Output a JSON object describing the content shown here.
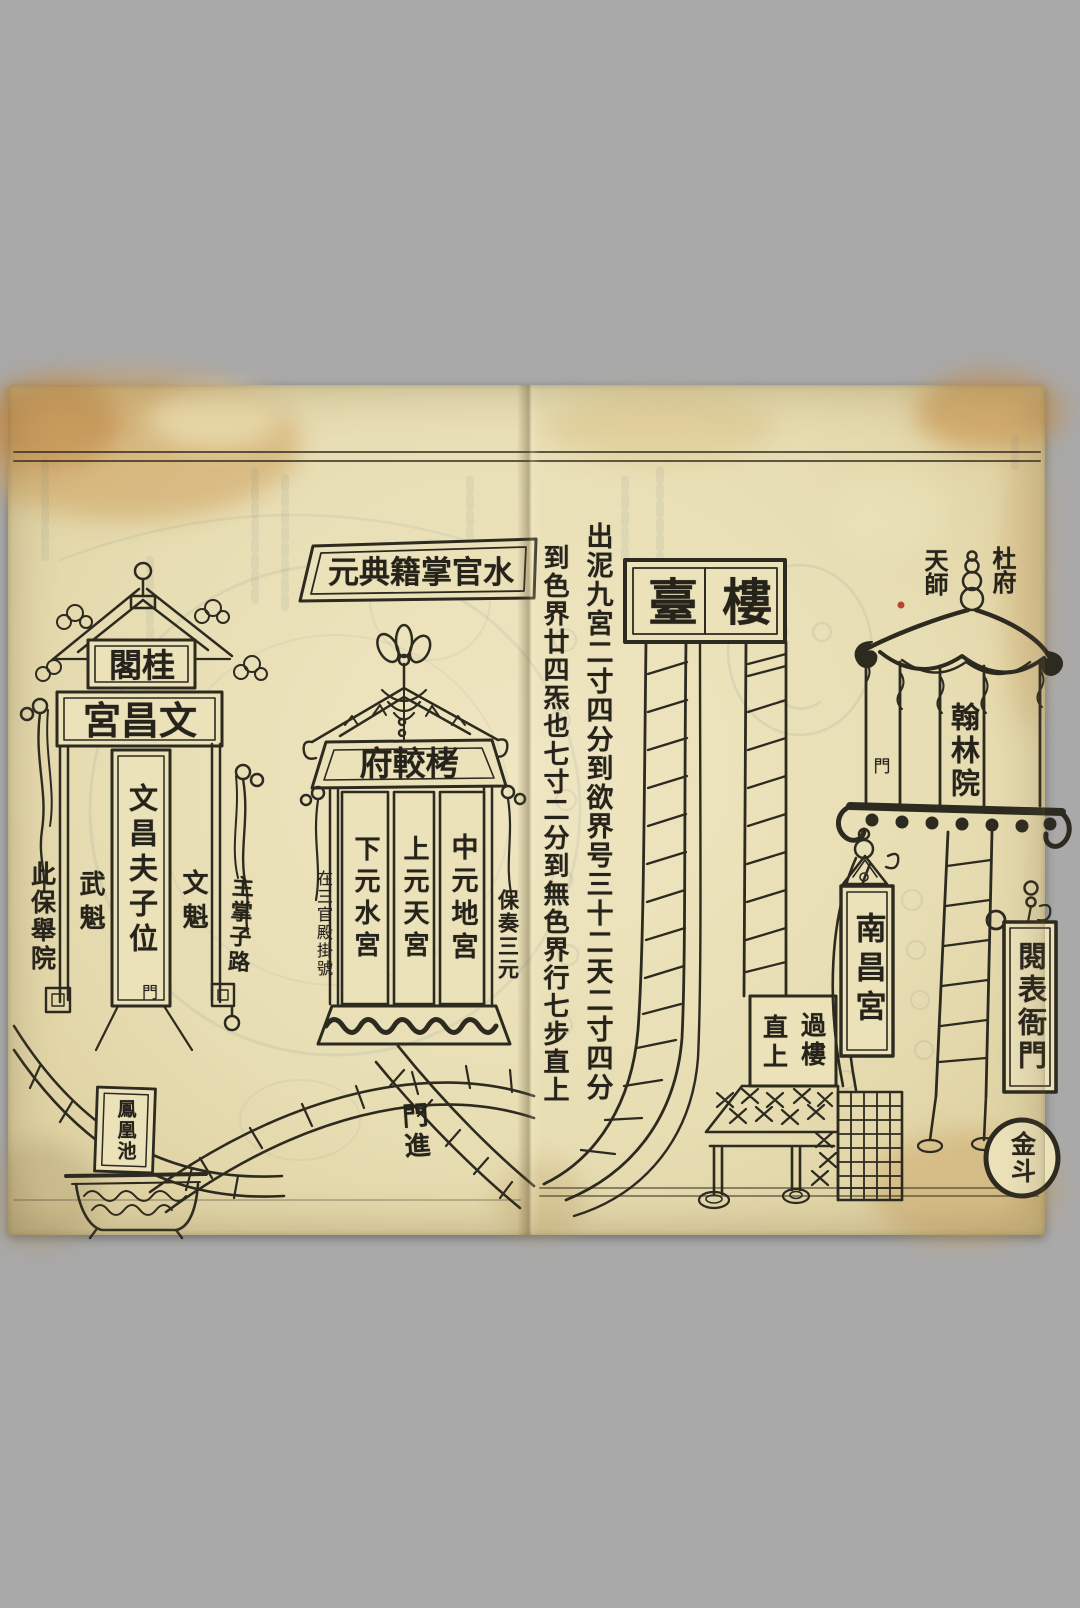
{
  "colors": {
    "background": "#a9a9a9",
    "paper": "#e8deb4",
    "ink": "#2d2a20",
    "stain": "#c89a5a",
    "bleedthrough": "#7f8f96"
  },
  "left_page": {
    "top_banner": "元典籍掌官水",
    "wenchang_gate": {
      "sign_top": "閣桂",
      "sign_main": "宮昌文",
      "panel_left": "武魁",
      "panel_center": "文昌夫子位",
      "panel_center_door": "門",
      "panel_right": "文魁"
    },
    "note_left_edge": "此保舉院",
    "note_zhuzhang": "主掌子路",
    "kaojiao_fu": {
      "sign": "府較栲",
      "panels": [
        "下元水宮",
        "上元天宮",
        "中元地宮"
      ],
      "note_registration": "在三官殿掛號",
      "note_baozou": "保奏三元"
    },
    "note_gate_entry": "門進",
    "phoenix_pond": "鳳凰池"
  },
  "center_inscription": {
    "first_column": "出泥九宮二寸四分到欲界号三十二天二寸四分",
    "second_column": "到色界廿四炁也七寸二分到無色界行七步直上"
  },
  "right_page": {
    "loutai_plaque": [
      "臺",
      "樓"
    ],
    "guolou_note": {
      "right_column": "過樓",
      "left_column": "直上"
    },
    "nanchang_plaque": "南昌宮",
    "pavilion": {
      "label_left": "天師",
      "label_right": "杜府",
      "hall_plaque": "翰林院",
      "door_note": "門"
    },
    "yuebiao_plaque": "閱表衙門",
    "jindou_seal": "金斗"
  }
}
